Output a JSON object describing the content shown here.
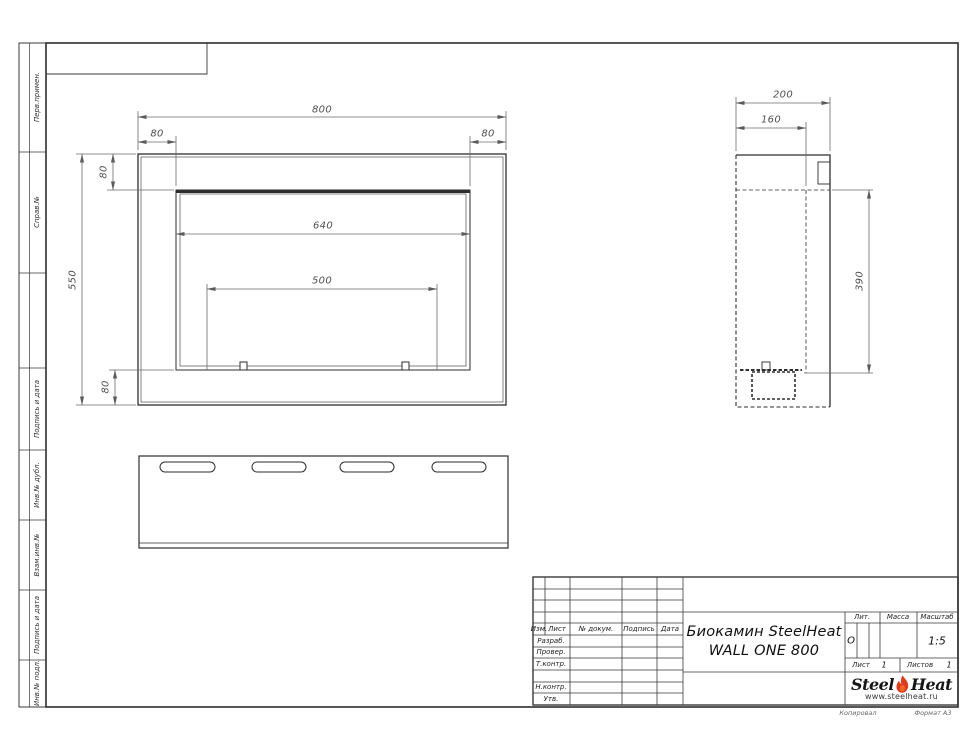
{
  "sheet": {
    "kopiroval": "Копировал",
    "format": "Формат А3"
  },
  "margin_labels": {
    "perv_primen": "Перв.примен.",
    "sprav_no": "Справ.№",
    "podpis_data_1": "Подпись и дата",
    "inv_dubl": "Инв.№ дубл.",
    "vzam_inv": "Взам.инв.№",
    "podpis_data_2": "Подпись и дата",
    "inv_podl": "Инв.№ подл."
  },
  "title_block": {
    "cols": {
      "izm": "Изм.",
      "list": "Лист",
      "doc": "№ докум.",
      "podpis": "Подпись",
      "data": "Дата"
    },
    "rows": {
      "razrab": "Разраб.",
      "prover": "Провер.",
      "tkontr": "Т.контр.",
      "nkontr": "Н.контр.",
      "utv": "Утв."
    },
    "title_line1": "Биокамин SteelHeat",
    "title_line2": "WALL ONE 800",
    "lit": {
      "label": "Лит.",
      "value": "О"
    },
    "massa": {
      "label": "Масса"
    },
    "masshtab": {
      "label": "Масштаб",
      "value": "1:5"
    },
    "list": {
      "label": "Лист",
      "value": "1"
    },
    "listov": {
      "label": "Листов",
      "value": "1"
    },
    "logo": {
      "steel": "Steel",
      "heat": "Heat",
      "site": "www.steelheat.ru"
    }
  },
  "dims": {
    "front": {
      "total_width": "800",
      "flange_left": "80",
      "flange_right": "80",
      "flange_top": "80",
      "total_height": "550",
      "flange_bottom": "80",
      "opening_width": "640",
      "burner_width": "500"
    },
    "side": {
      "depth": "200",
      "inner_depth": "160",
      "opening_height": "390"
    }
  }
}
